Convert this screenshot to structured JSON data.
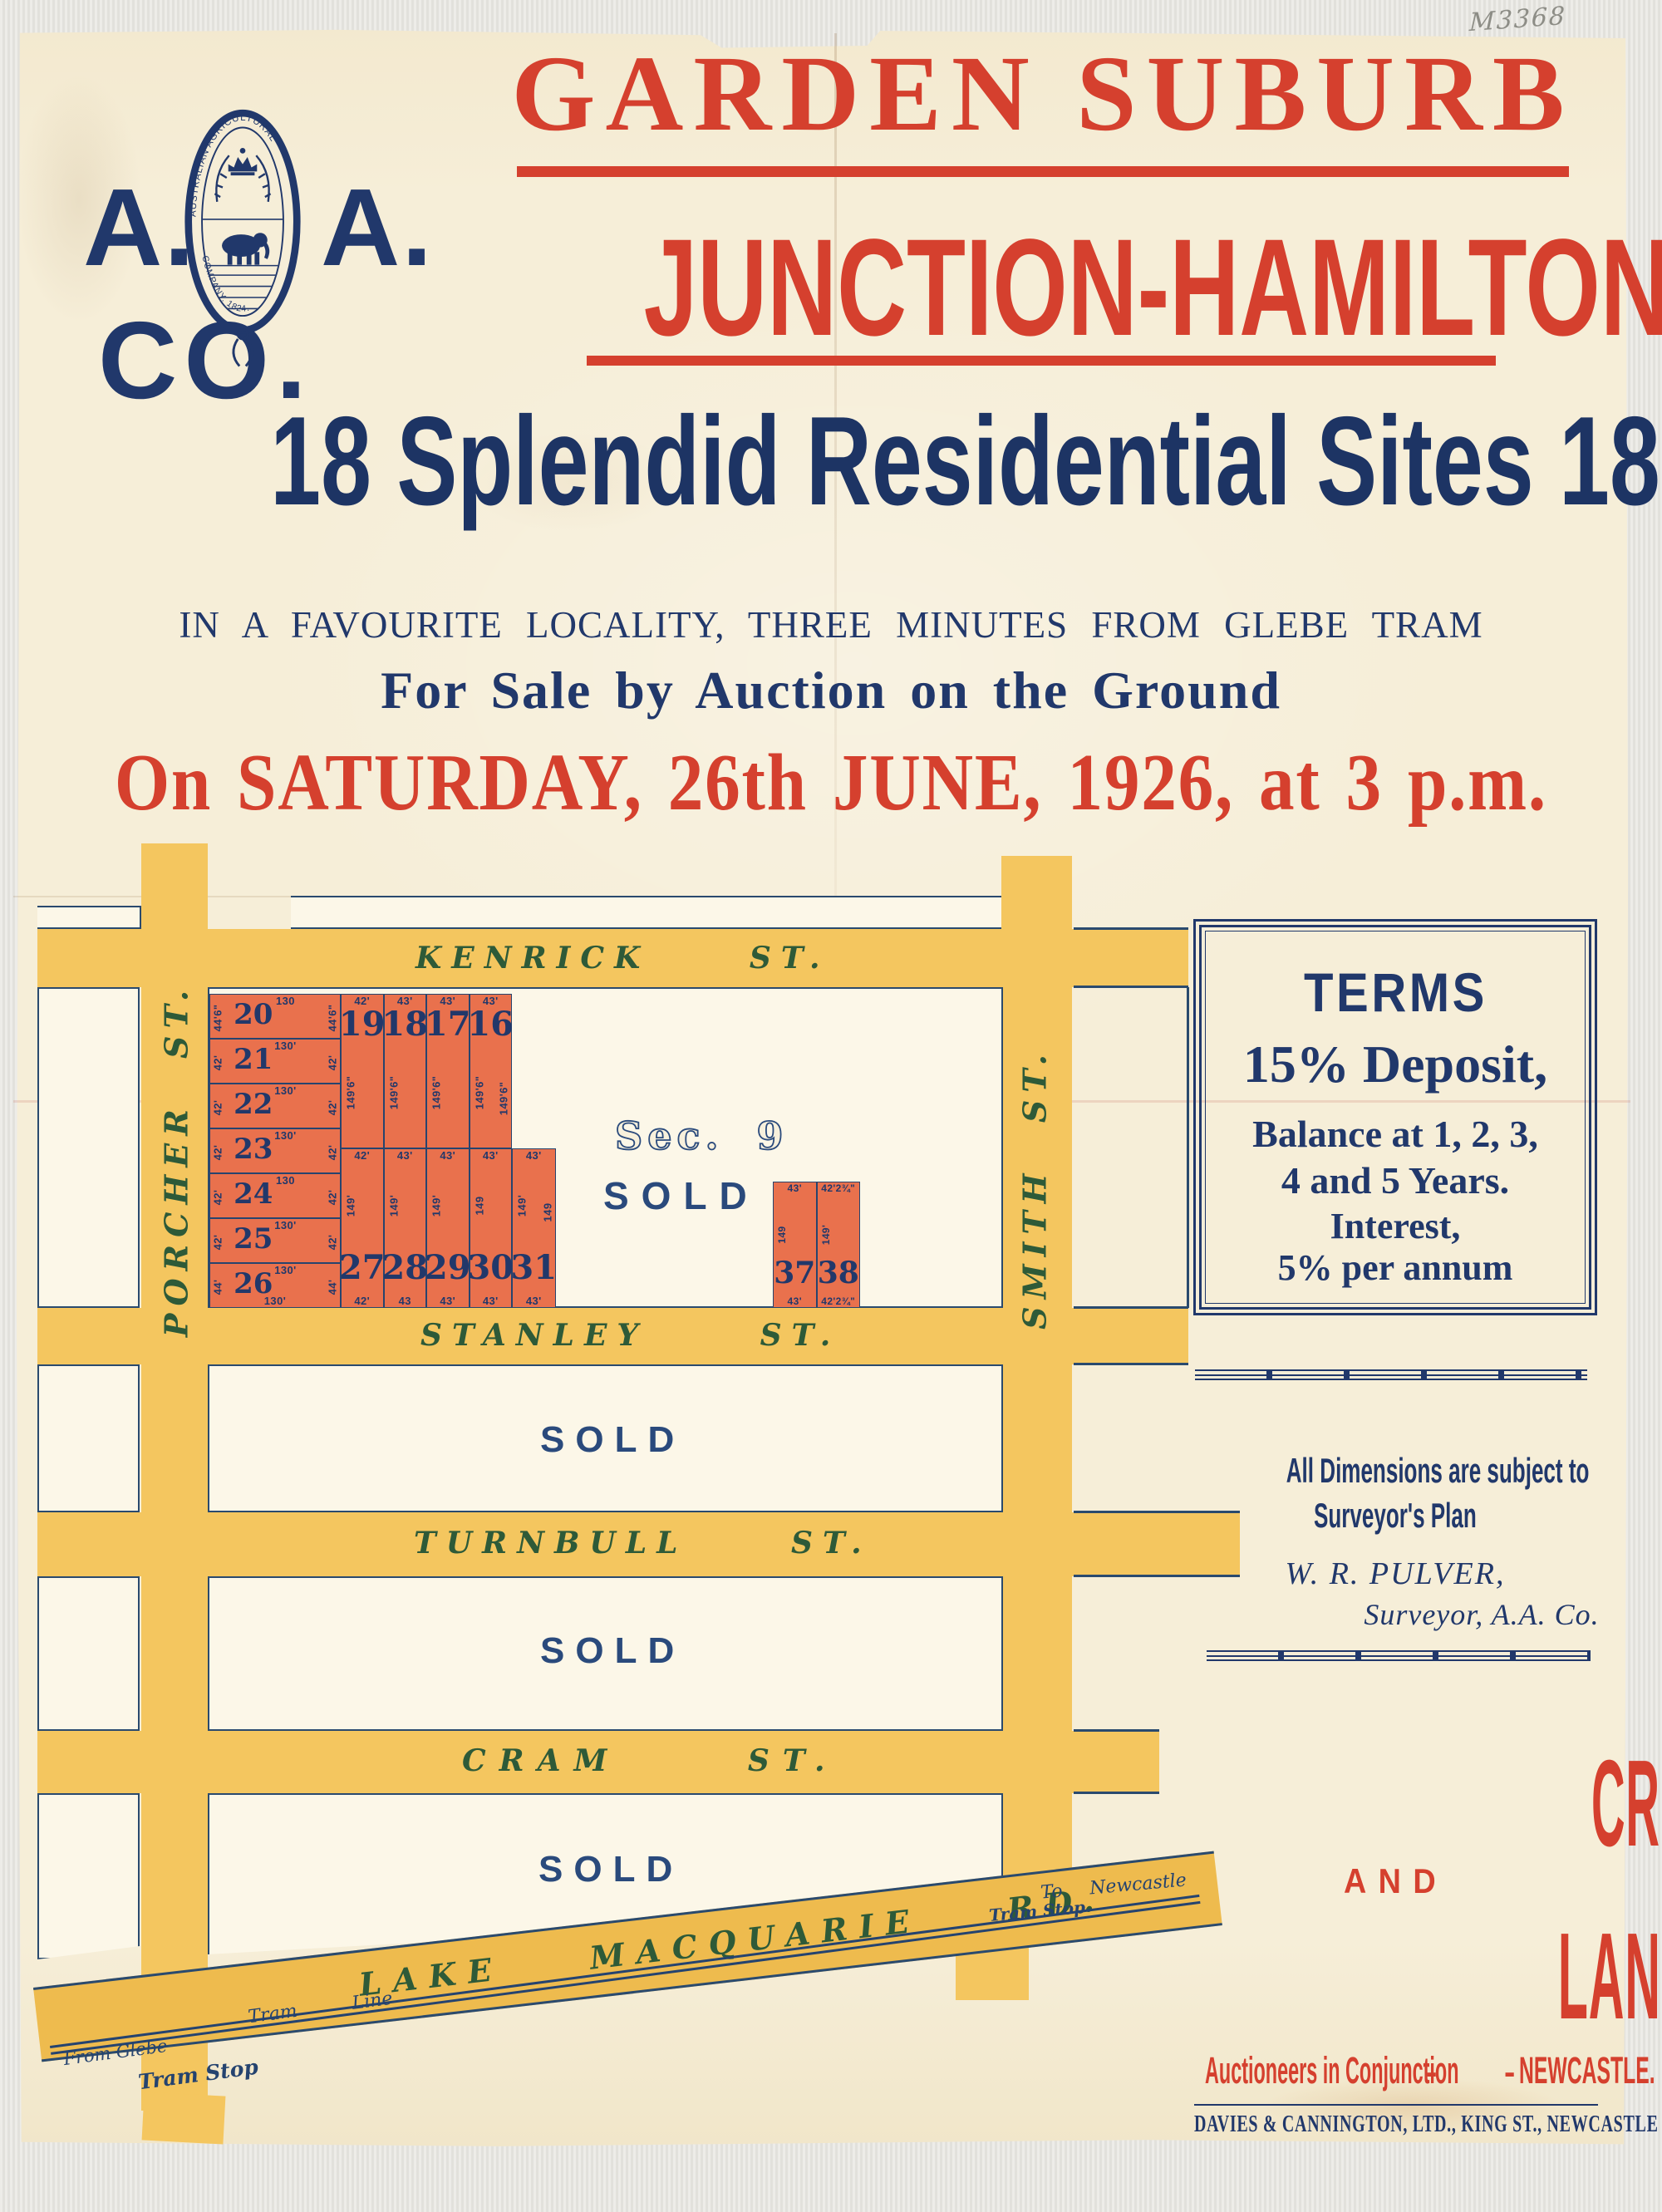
{
  "annotation": "M3368",
  "logo": {
    "a_left": "A.",
    "a_right": "A.",
    "co": "CO.",
    "seal_top": "AUSTRALIAN AGRICULTURAL",
    "seal_bottom": "COMPANY. 1824."
  },
  "header": {
    "title_line1": "GARDEN SUBURB",
    "title_line2": "JUNCTION-HAMILTON",
    "sites_line": "18 Splendid Residential Sites 18",
    "locality_line": "IN A FAVOURITE LOCALITY, THREE MINUTES FROM GLEBE TRAM",
    "sale_line": "For Sale by Auction on the Ground",
    "date_line": "On SATURDAY, 26th JUNE, 1926, at 3 p.m."
  },
  "map": {
    "section_label": "Sec. 9",
    "sold_label": "SOLD",
    "streets": {
      "kenrick": "KENRICK ST.",
      "porcher": "PORCHER ST.",
      "smith": "SMITH ST.",
      "stanley": "STANLEY ST.",
      "turnbull": "TURNBULL ST.",
      "cram": "CRAM ST.",
      "lake_macquarie": "LAKE MACQUARIE RD."
    },
    "tram": {
      "from_glebe": "From Glebe",
      "tram_stop_west": "Tram Stop",
      "tram_line": "Tram Line",
      "tram_stop_east": "Tram Stop",
      "to_newcastle": "To Newcastle"
    },
    "lots": {
      "west": [
        {
          "n": "20",
          "top": "130",
          "side": "44'6\""
        },
        {
          "n": "21",
          "top": "130'",
          "side": "42'"
        },
        {
          "n": "22",
          "top": "130'",
          "side": "42'"
        },
        {
          "n": "23",
          "top": "130'",
          "side": "42'"
        },
        {
          "n": "24",
          "top": "130",
          "side": "42'"
        },
        {
          "n": "25",
          "top": "130'",
          "side": "42'"
        },
        {
          "n": "26",
          "top": "130'",
          "side": "44'",
          "bottom": "130'"
        }
      ],
      "north": [
        {
          "n": "19",
          "top": "42'",
          "vert": "149'6\""
        },
        {
          "n": "18",
          "top": "43'",
          "vert": "149'6\""
        },
        {
          "n": "17",
          "top": "43'",
          "vert": "149'6\""
        },
        {
          "n": "16",
          "top": "43'",
          "vert": "149'6\"",
          "vert2": "149'6\""
        }
      ],
      "south": [
        {
          "n": "27",
          "top": "42'",
          "vert": "149'",
          "bottom": "42'"
        },
        {
          "n": "28",
          "top": "43'",
          "vert": "149'",
          "bottom": "43"
        },
        {
          "n": "29",
          "top": "43'",
          "vert": "149'",
          "bottom": "43'"
        },
        {
          "n": "30",
          "top": "43'",
          "vert": "149",
          "bottom": "43'"
        },
        {
          "n": "31",
          "top": "43'",
          "vert": "149'",
          "vert2": "149",
          "bottom": "43'"
        }
      ],
      "east_pair": [
        {
          "n": "37",
          "top": "43'",
          "vert": "149",
          "bottom": "43'"
        },
        {
          "n": "38",
          "top": "42'2¾\"",
          "vert": "149'",
          "bottom": "42'2¾\""
        }
      ]
    }
  },
  "terms": {
    "heading": "TERMS",
    "deposit": "15% Deposit,",
    "balance1": "Balance at 1, 2, 3,",
    "balance2": "4 and 5 Years.",
    "interest1": "Interest,",
    "interest2": "5% per annum"
  },
  "notes": {
    "dims1": "All Dimensions are subject to",
    "dims2": "Surveyor's Plan",
    "surveyor_name": "W. R. PULVER,",
    "surveyor_title": "Surveyor, A.A. Co."
  },
  "auctioneers": {
    "firm1": "CREER & BERKELEY",
    "conj": "AND",
    "firm2": "LANG, WOOD & CO.",
    "line": "Auctioneers in Conjunction",
    "dashes": "-      -",
    "city": "NEWCASTLE."
  },
  "printer": "DAVIES & CANNINGTON, LTD., KING ST., NEWCASTLE",
  "colors": {
    "red": "#d5402e",
    "navy": "#21386b",
    "street_yellow": "#f4c65f",
    "road_yellow": "#eebb4e",
    "lot_orange": "#e9714d",
    "street_name_green": "#2e5a38",
    "paper_cream": "#f6eed8"
  }
}
